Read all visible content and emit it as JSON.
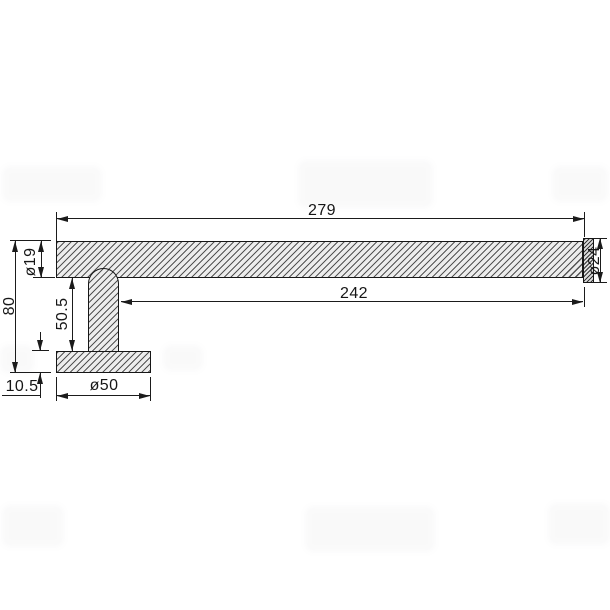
{
  "drawing": {
    "type": "technical-dimension-drawing",
    "part": "towel rail side view",
    "line_color": "#1b1b1b",
    "dims": {
      "overall_length": "279",
      "bar_length": "242",
      "bar_diameter": "ø19",
      "cap_diameter": "ø24",
      "total_height": "80",
      "post_height": "50.5",
      "base_thickness": "10.5",
      "base_diameter": "ø50"
    }
  }
}
